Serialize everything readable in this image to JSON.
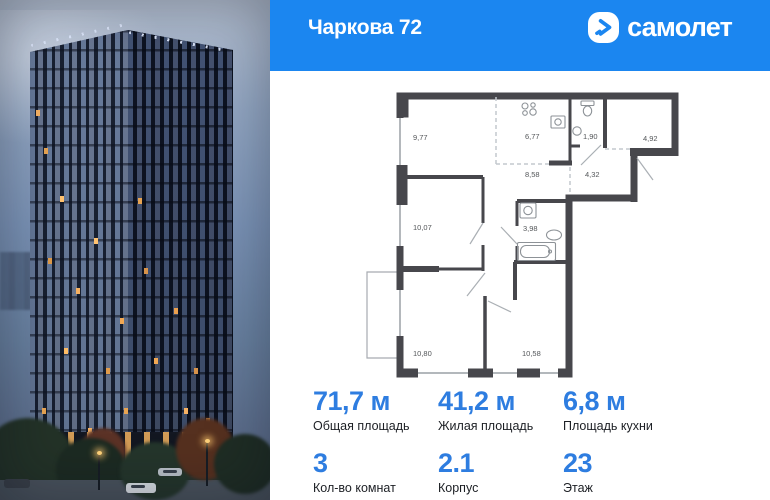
{
  "header": {
    "title": "Чаркова 72",
    "logo_text": "самолет"
  },
  "colors": {
    "header_blue": "#1b86f0",
    "accent_blue": "#2e7de0",
    "wall_gray": "#47474c"
  },
  "floor_plan": {
    "rooms": [
      {
        "name": "room-1",
        "area": "9,77"
      },
      {
        "name": "kitchen",
        "area": "6,77"
      },
      {
        "name": "wc",
        "area": "1,90"
      },
      {
        "name": "loggia",
        "area": "4,92"
      },
      {
        "name": "hallway",
        "area": "8,58"
      },
      {
        "name": "hallway-2",
        "area": "4,32"
      },
      {
        "name": "room-2",
        "area": "10,07"
      },
      {
        "name": "bathroom",
        "area": "3,98"
      },
      {
        "name": "room-3",
        "area": "10,80"
      },
      {
        "name": "room-4",
        "area": "10,58"
      }
    ]
  },
  "stats": {
    "items": [
      {
        "value": "71,7 м",
        "label": "Общая площадь"
      },
      {
        "value": "41,2 м",
        "label": "Жилая площадь"
      },
      {
        "value": "6,8 м",
        "label": "Площадь кухни"
      },
      {
        "value": "3",
        "label": "Кол-во комнат"
      },
      {
        "value": "2.1",
        "label": "Корпус"
      },
      {
        "value": "23",
        "label": "Этаж"
      }
    ]
  }
}
